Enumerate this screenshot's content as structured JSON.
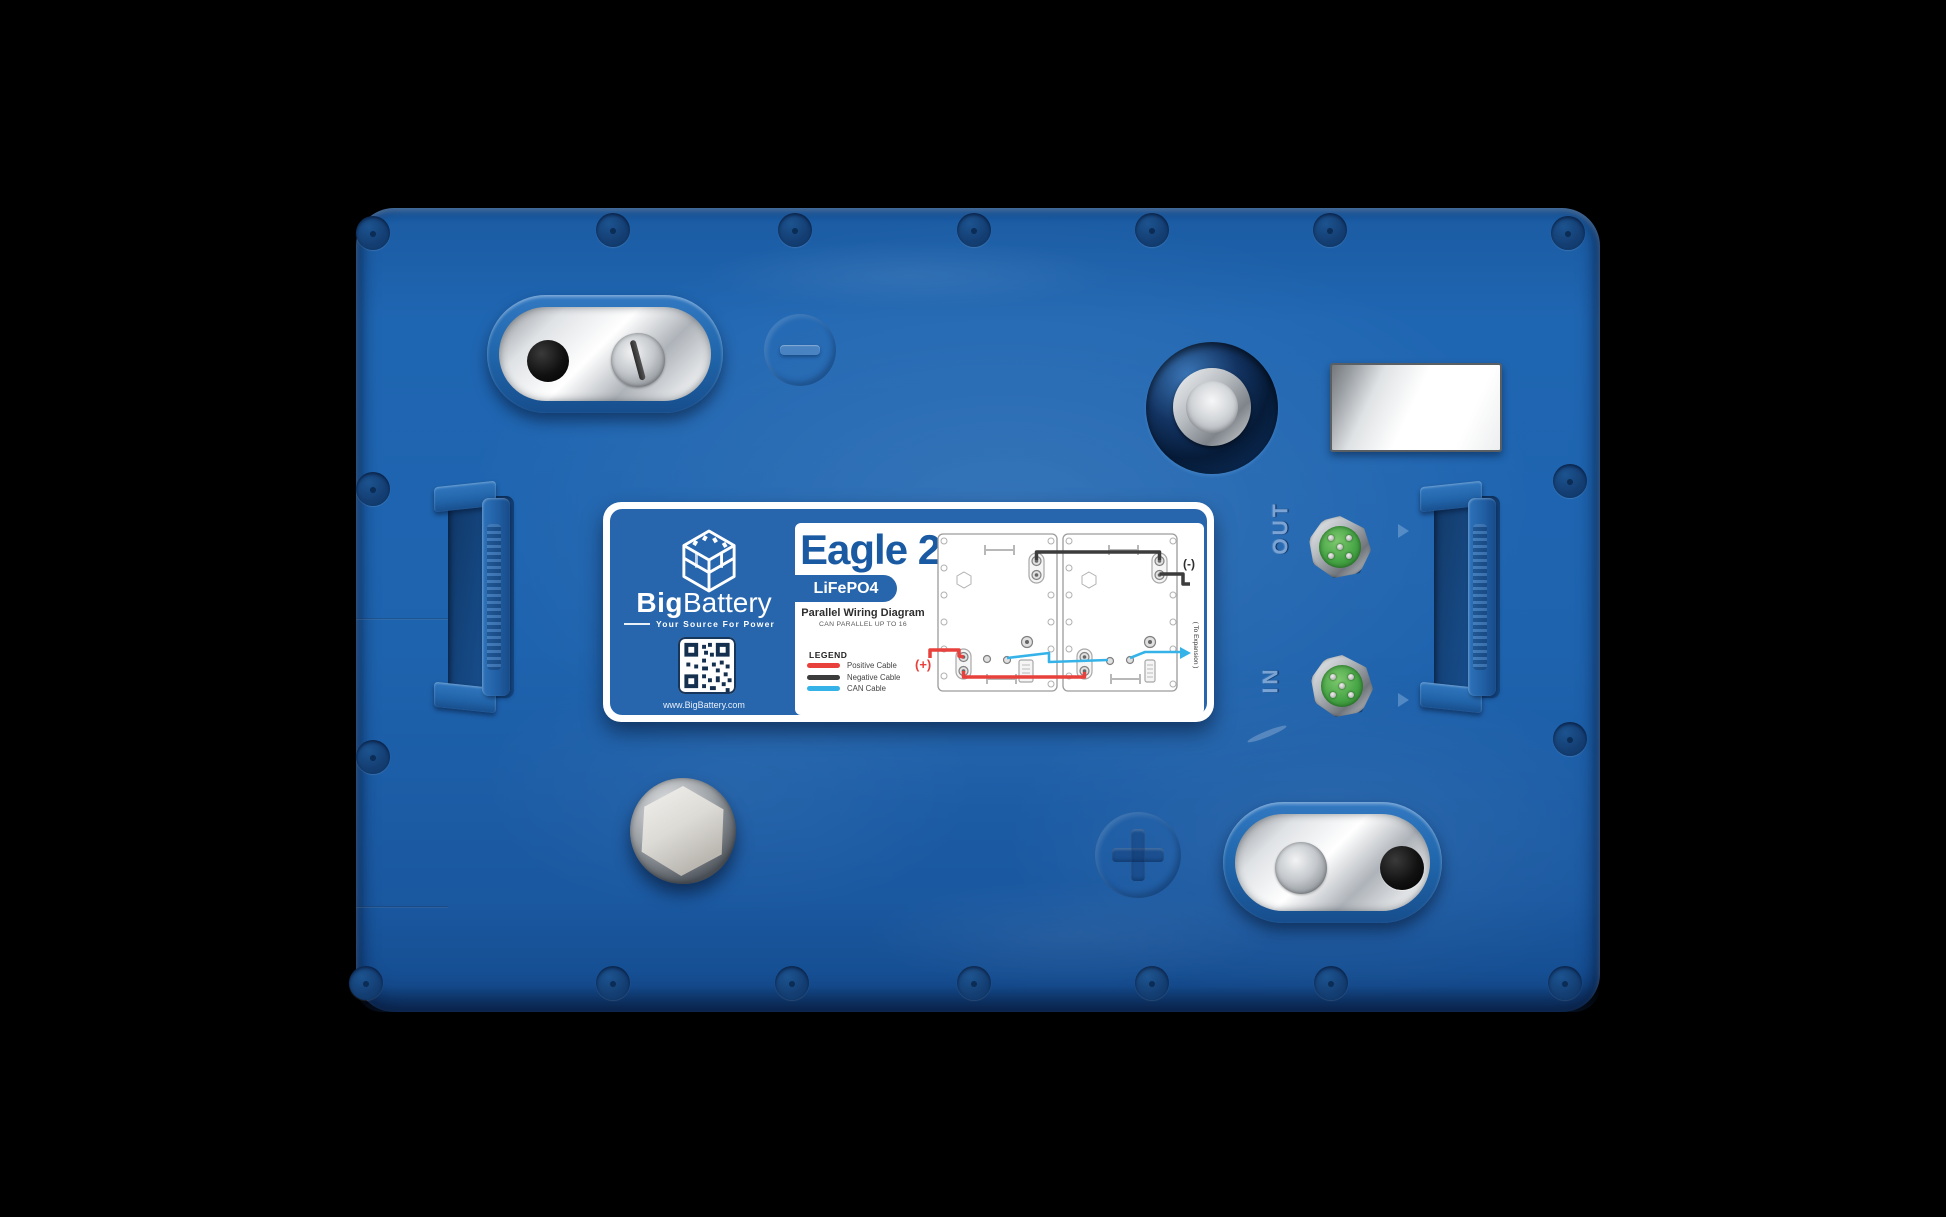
{
  "label": {
    "model": "Eagle 2",
    "chemistry": "LiFePO4",
    "brand_bold": "Big",
    "brand_regular": "Battery",
    "tagline": "Your Source For Power",
    "website": "www.BigBattery.com",
    "diagram_title": "Parallel Wiring Diagram",
    "diagram_subtitle": "CAN PARALLEL UP TO 16",
    "legend_title": "LEGEND",
    "legend_items": [
      {
        "label": "Positive Cable",
        "color": "#e8403b"
      },
      {
        "label": "Negative Cable",
        "color": "#3c3c3c"
      },
      {
        "label": "CAN Cable",
        "color": "#35b3e9"
      }
    ],
    "positive_marker": "(+)",
    "negative_marker": "(-)",
    "expansion_note": "( To Expansion )"
  },
  "ports": {
    "out": "OUT",
    "in": "IN"
  },
  "colors": {
    "body_blue": "#1e63ae",
    "label_blue": "#2765ad",
    "brand_navy": "#1a5aa2",
    "positive_red": "#e8403b",
    "negative_black": "#3c3c3c",
    "can_blue": "#35b3e9",
    "connector_green": "#46a545"
  }
}
